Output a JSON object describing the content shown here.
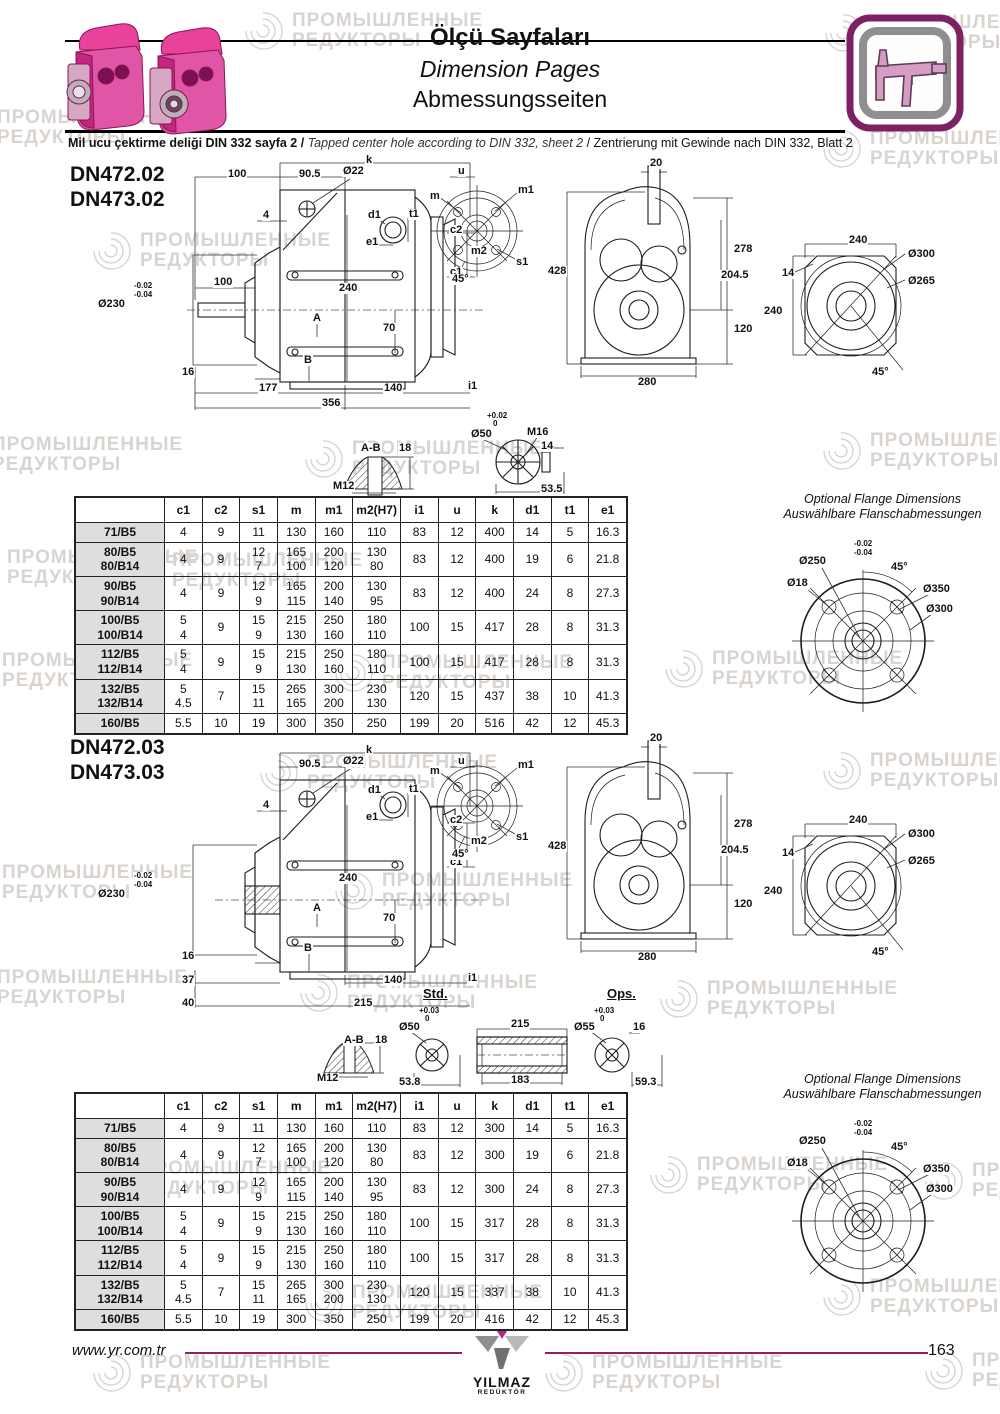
{
  "header": {
    "title_tr": "Ölçü Sayfaları",
    "title_en": "Dimension Pages",
    "title_de": "Abmessungsseiten",
    "subtitle_tr": "Mil ucu çektirme deliği DIN 332 sayfa 2 / ",
    "subtitle_en": "Tapped center hole according to DIN 332, sheet 2 ",
    "subtitle_de": "/ Zentrierung mit Gewinde nach DIN 332, Blatt 2"
  },
  "watermark": {
    "line1": "ПРОМЫШЛЕННЫЕ",
    "line2": "РЕДУКТОРЫ",
    "items": [
      [
        -55,
        105
      ],
      [
        240,
        8
      ],
      [
        820,
        10
      ],
      [
        88,
        228
      ],
      [
        818,
        126
      ],
      [
        -60,
        432
      ],
      [
        300,
        436
      ],
      [
        818,
        428
      ],
      [
        -45,
        545
      ],
      [
        120,
        548
      ],
      [
        -50,
        648
      ],
      [
        330,
        650
      ],
      [
        660,
        646
      ],
      [
        255,
        750
      ],
      [
        818,
        748
      ],
      [
        -50,
        860
      ],
      [
        330,
        868
      ],
      [
        -55,
        965
      ],
      [
        295,
        970
      ],
      [
        655,
        976
      ],
      [
        88,
        1156
      ],
      [
        645,
        1152
      ],
      [
        920,
        1158
      ],
      [
        300,
        1280
      ],
      [
        818,
        1274
      ],
      [
        88,
        1350
      ],
      [
        540,
        1350
      ],
      [
        920,
        1348
      ]
    ]
  },
  "sections": [
    {
      "model1": "DN472.02",
      "model2": "DN473.02",
      "table": {
        "headers": [
          "",
          "c1",
          "c2",
          "s1",
          "m",
          "m1",
          "m2(H7)",
          "i1",
          "u",
          "k",
          "d1",
          "t1",
          "e1"
        ],
        "rows": [
          {
            "label": "71/B5",
            "cells": [
              "4",
              "9",
              "11",
              "130",
              "160",
              "110",
              "83",
              "12",
              "400",
              "14",
              "5",
              "16.3"
            ]
          },
          {
            "label": "80/B5\n80/B14",
            "cells": [
              "4",
              "9",
              "12\n7",
              "165\n100",
              "200\n120",
              "130\n80",
              "83",
              "12",
              "400",
              "19",
              "6",
              "21.8"
            ]
          },
          {
            "label": "90/B5\n90/B14",
            "cells": [
              "4",
              "9",
              "12\n9",
              "165\n115",
              "200\n140",
              "130\n95",
              "83",
              "12",
              "400",
              "24",
              "8",
              "27.3"
            ]
          },
          {
            "label": "100/B5\n100/B14",
            "cells": [
              "5\n4",
              "9",
              "15\n9",
              "215\n130",
              "250\n160",
              "180\n110",
              "100",
              "15",
              "417",
              "28",
              "8",
              "31.3"
            ]
          },
          {
            "label": "112/B5\n112/B14",
            "cells": [
              "5\n4",
              "9",
              "15\n9",
              "215\n130",
              "250\n160",
              "180\n110",
              "100",
              "15",
              "417",
              "28",
              "8",
              "31.3"
            ]
          },
          {
            "label": "132/B5\n132/B14",
            "cells": [
              "5\n4.5",
              "7",
              "15\n11",
              "265\n165",
              "300\n200",
              "230\n130",
              "120",
              "15",
              "437",
              "38",
              "10",
              "41.3"
            ]
          },
          {
            "label": "160/B5",
            "cells": [
              "5.5",
              "10",
              "19",
              "300",
              "350",
              "250",
              "199",
              "20",
              "516",
              "42",
              "12",
              "45.3"
            ]
          }
        ]
      },
      "optional_flange": {
        "title_en": "Optional Flange Dimensions",
        "title_de": "Auswählbare Flanschabmessungen"
      }
    },
    {
      "model1": "DN472.03",
      "model2": "DN473.03",
      "table": {
        "headers": [
          "",
          "c1",
          "c2",
          "s1",
          "m",
          "m1",
          "m2(H7)",
          "i1",
          "u",
          "k",
          "d1",
          "t1",
          "e1"
        ],
        "rows": [
          {
            "label": "71/B5",
            "cells": [
              "4",
              "9",
              "11",
              "130",
              "160",
              "110",
              "83",
              "12",
              "300",
              "14",
              "5",
              "16.3"
            ]
          },
          {
            "label": "80/B5\n80/B14",
            "cells": [
              "4",
              "9",
              "12\n7",
              "165\n100",
              "200\n120",
              "130\n80",
              "83",
              "12",
              "300",
              "19",
              "6",
              "21.8"
            ]
          },
          {
            "label": "90/B5\n90/B14",
            "cells": [
              "4",
              "9",
              "12\n9",
              "165\n115",
              "200\n140",
              "130\n95",
              "83",
              "12",
              "300",
              "24",
              "8",
              "27.3"
            ]
          },
          {
            "label": "100/B5\n100/B14",
            "cells": [
              "5\n4",
              "9",
              "15\n9",
              "215\n130",
              "250\n160",
              "180\n110",
              "100",
              "15",
              "317",
              "28",
              "8",
              "31.3"
            ]
          },
          {
            "label": "112/B5\n112/B14",
            "cells": [
              "5\n4",
              "9",
              "15\n9",
              "215\n130",
              "250\n160",
              "180\n110",
              "100",
              "15",
              "317",
              "28",
              "8",
              "31.3"
            ]
          },
          {
            "label": "132/B5\n132/B14",
            "cells": [
              "5\n4.5",
              "7",
              "15\n11",
              "265\n165",
              "300\n200",
              "230\n130",
              "120",
              "15",
              "337",
              "38",
              "10",
              "41.3"
            ]
          },
          {
            "label": "160/B5",
            "cells": [
              "5.5",
              "10",
              "19",
              "300",
              "350",
              "250",
              "199",
              "20",
              "416",
              "42",
              "12",
              "45.3"
            ]
          }
        ]
      },
      "optional_flange": {
        "title_en": "Optional Flange Dimensions",
        "title_de": "Auswählbare Flanschabmessungen"
      }
    }
  ],
  "annotations": {
    "sv1": [
      [
        "k",
        270,
        0
      ],
      [
        "100",
        132,
        14
      ],
      [
        "90.5",
        203,
        14
      ],
      [
        "Ø22",
        247,
        11
      ],
      [
        "u",
        362,
        11
      ],
      [
        "4",
        167,
        55
      ],
      [
        "c2",
        354,
        70
      ],
      [
        "m2",
        375,
        91
      ],
      [
        "c1",
        354,
        112
      ],
      [
        "100",
        118,
        122
      ],
      [
        "-0.02",
        38,
        127,
        "s"
      ],
      [
        "-0.04",
        38,
        136,
        "s"
      ],
      [
        "Ø230",
        2,
        144
      ],
      [
        "240",
        243,
        128
      ],
      [
        "A",
        217,
        158
      ],
      [
        "70",
        287,
        168
      ],
      [
        "16",
        86,
        212
      ],
      [
        "B",
        208,
        200
      ],
      [
        "177",
        163,
        228
      ],
      [
        "140",
        288,
        228
      ],
      [
        "i1",
        372,
        226
      ],
      [
        "356",
        226,
        243
      ]
    ],
    "sv2": [
      [
        "k",
        270,
        0
      ],
      [
        "90.5",
        203,
        14
      ],
      [
        "Ø22",
        247,
        11
      ],
      [
        "u",
        362,
        11
      ],
      [
        "4",
        167,
        55
      ],
      [
        "c2",
        354,
        70
      ],
      [
        "m2",
        375,
        91
      ],
      [
        "c1",
        354,
        112
      ],
      [
        "-0.02",
        38,
        127,
        "s"
      ],
      [
        "-0.04",
        38,
        136,
        "s"
      ],
      [
        "Ø230",
        2,
        144
      ],
      [
        "240",
        243,
        128
      ],
      [
        "A",
        217,
        158
      ],
      [
        "70",
        287,
        168
      ],
      [
        "16",
        86,
        206
      ],
      [
        "B",
        208,
        198
      ],
      [
        "37",
        86,
        230
      ],
      [
        "140",
        288,
        230
      ],
      [
        "i1",
        372,
        228
      ],
      [
        "40",
        86,
        253
      ],
      [
        "215",
        258,
        253
      ]
    ],
    "ss": [
      [
        "d1",
        2,
        10
      ],
      [
        "t1",
        43,
        9
      ],
      [
        "e1",
        0,
        37
      ]
    ],
    "fc": [
      [
        "m",
        4,
        16
      ],
      [
        "m1",
        92,
        10
      ],
      [
        "s1",
        90,
        82
      ],
      [
        "45°",
        26,
        99
      ]
    ],
    "fv": [
      [
        "20",
        104,
        0
      ],
      [
        "428",
        2,
        108
      ],
      [
        "278",
        188,
        86
      ],
      [
        "204.5",
        175,
        112
      ],
      [
        "120",
        188,
        166
      ],
      [
        "280",
        92,
        219
      ]
    ],
    "sq": [
      [
        "240",
        93,
        5
      ],
      [
        "Ø300",
        152,
        19
      ],
      [
        "14",
        26,
        38
      ],
      [
        "Ø265",
        152,
        46
      ],
      [
        "240",
        8,
        76
      ],
      [
        "45°",
        116,
        137
      ]
    ],
    "ab1": [
      [
        "A-B",
        30,
        28
      ],
      [
        "18",
        68,
        28
      ],
      [
        "M12",
        2,
        66
      ]
    ],
    "se1": [
      [
        "+0.02",
        26,
        0,
        "s"
      ],
      [
        "0",
        32,
        8,
        "s"
      ],
      [
        "Ø50",
        10,
        17
      ],
      [
        "M16",
        66,
        15
      ],
      [
        "14",
        80,
        29
      ],
      [
        "53.5",
        80,
        72
      ]
    ],
    "d2": [
      [
        "A-B",
        33,
        50
      ],
      [
        "18",
        64,
        50
      ],
      [
        "M12",
        6,
        88
      ],
      [
        "Std.",
        112,
        2,
        "u"
      ],
      [
        "+0.03",
        108,
        22,
        "s"
      ],
      [
        "0",
        114,
        30,
        "s"
      ],
      [
        "Ø50",
        88,
        37
      ],
      [
        "53.8",
        88,
        92
      ],
      [
        "215",
        200,
        34
      ],
      [
        "183",
        200,
        90
      ],
      [
        "Ops.",
        296,
        2,
        "u"
      ],
      [
        "+0.03",
        283,
        22,
        "s"
      ],
      [
        "0",
        289,
        30,
        "s"
      ],
      [
        "Ø55",
        263,
        37
      ],
      [
        "16",
        322,
        37
      ],
      [
        "59.3",
        324,
        92
      ]
    ],
    "of": [
      [
        "-0.02",
        83,
        48,
        "s"
      ],
      [
        "-0.04",
        83,
        57,
        "s"
      ],
      [
        "Ø250",
        28,
        64
      ],
      [
        "45°",
        120,
        70
      ],
      [
        "Ø18",
        16,
        86
      ],
      [
        "Ø350",
        152,
        92
      ],
      [
        "Ø300",
        155,
        112
      ]
    ]
  },
  "footer": {
    "url": "www.yr.com.tr",
    "brand": "YILMAZ",
    "brand_sub": "REDÜKTÖR",
    "page": "163"
  }
}
